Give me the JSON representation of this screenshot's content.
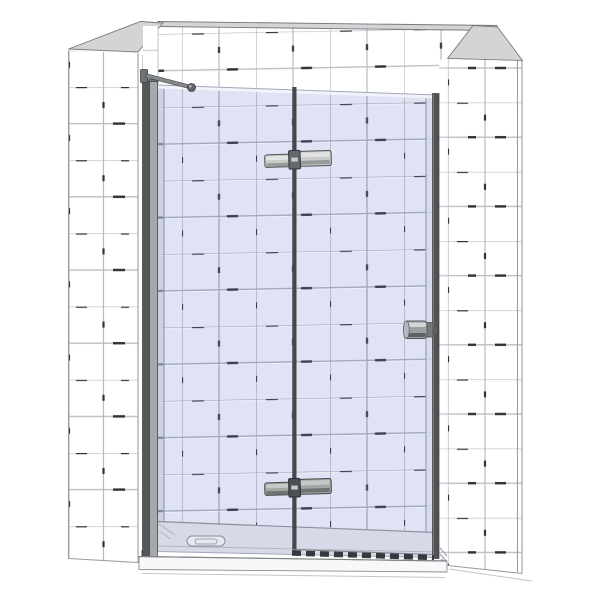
{
  "meta": {
    "title": "Frameless hinged glass shower door installed in a white-tiled alcove – 3D product rendering"
  },
  "scene": {
    "setting": "tiled alcove with shower tray",
    "parts": {
      "left_wall": "white tiled wall, left side",
      "right_wall": "white tiled wall, right side",
      "back_wall": "white tiled back wall seen above and through the glass",
      "fixed_panel": "fixed glass side panel (left)",
      "door": "hinged pivot glass door (right)",
      "top_hinge": "metal glass-to-glass hinge, upper",
      "bottom_hinge": "metal glass-to-glass hinge, lower",
      "knob": "cylindrical metal door knob on right edge of door",
      "support_bar": "diagonal wall-to-glass support bar, top left",
      "wall_profile": "vertical metal wall profile, left glass edge",
      "door_edge_profile": "dark vertical door edge, right",
      "shower_tray": "low shower tray with oval drain cover",
      "bottom_seal": "dark dashed water seal under door",
      "floor": "plain white floor"
    }
  },
  "colors": {
    "background": "#ffffff",
    "tile": "#ffffff",
    "grout": "#b6b9bf",
    "grout_hi": "#fbfbfc",
    "grout_dash": "#2f3236",
    "wall_cap": "#d3d4d6",
    "outline": "#77797c",
    "edge_line": "#9a9da2",
    "faint_line": "#c3c5c8",
    "glass": "#dfe3f3",
    "glass_grout": "#9aa0b8",
    "glass_grout_hi": "#eef1f9",
    "glass_dash": "#3c404c",
    "glass_highlight": "#f2f4fb",
    "glass_outline": "#a2a8bc",
    "reveal_glass": "#ccd1e6",
    "glass_edge_tint": "#d5d9eb",
    "profile_dark": "#55575a",
    "profile_light": "#a6a8ab",
    "profile_outline": "#3c3e41",
    "junction": "#46474b",
    "door_edge": "#505256",
    "door_edge_hi": "#7e8286",
    "hinge_plate": "#c9ccc9",
    "hinge_plate_hi": "#e2e4e1",
    "hinge_plate_lo": "#989c99",
    "hinge_pivot": "#64686c",
    "hinge2_plate": "#a4a8a5",
    "hinge2_plate_hi": "#c6c9c6",
    "hinge2_plate_lo": "#707470",
    "hinge2_pivot": "#4c5054",
    "knob_body": "#9aa0a4",
    "knob_highlight": "#d2d5d7",
    "knob_shade": "#5e6266",
    "knob_ring": "#75797c",
    "knob_cap": "#b4b8bb",
    "support_bar": "#85898c",
    "support_ball": "#63676a",
    "bracket": "#6f7376",
    "tray_top": "#d6d9e7",
    "tray_line": "#8d909b",
    "tray_front": "#f7f8fa",
    "drain": "#e6e8f1",
    "drain_line": "#8a8d96",
    "seal": "#36393d",
    "corner_dark": "#4c4e51"
  }
}
